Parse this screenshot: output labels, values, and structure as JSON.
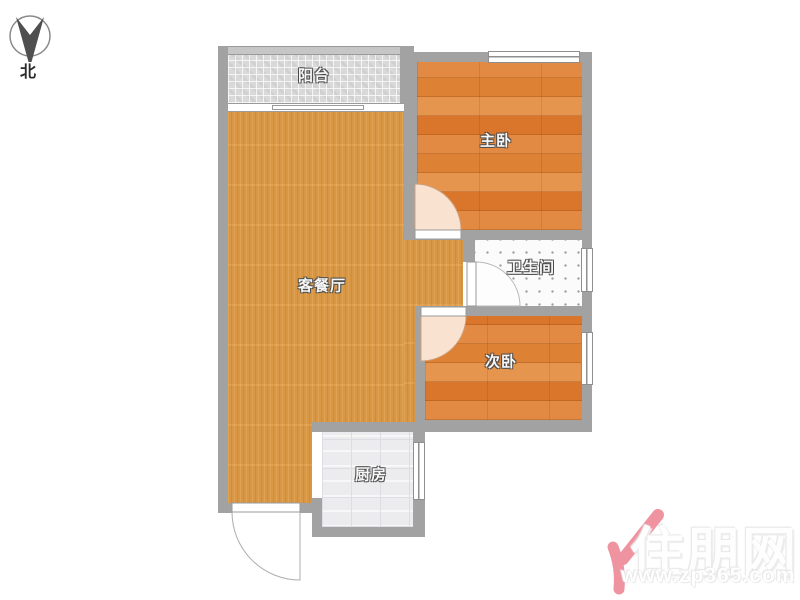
{
  "plan_title": "two-bedroom apartment floor plan",
  "compass": {
    "north_label": "北"
  },
  "rooms": {
    "balcony": "阳台",
    "master_bedroom": "主卧",
    "living_dining": "客餐厅",
    "bathroom": "卫生间",
    "second_bedroom": "次卧",
    "kitchen": "厨房"
  },
  "watermark": {
    "brand": "住朋网",
    "url": "www.zp365.com"
  },
  "colors": {
    "wall": "#a2a2a2",
    "living_floor": "#e09c45",
    "bedroom_floor": "#de8038",
    "balcony_tile": "#d9d9d9",
    "bathroom_tile": "#fbfbfb",
    "kitchen_tile": "#ececef",
    "door_swing": "#f9e3d0",
    "watermark_pink": "#ef93a0"
  }
}
